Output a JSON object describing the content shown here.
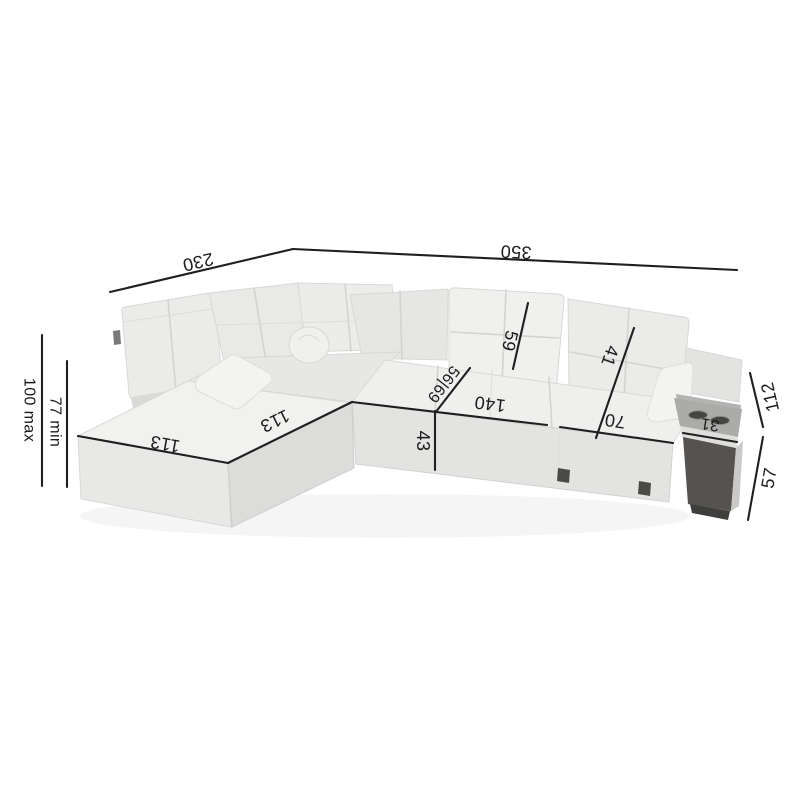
{
  "dims": {
    "total_width": "350",
    "total_depth": "230",
    "height_max": "100 max",
    "height_min": "77 min",
    "chaise_front_length": "113",
    "chaise_inner_depth": "113",
    "center_seat_width": "140",
    "right_seat_width": "70",
    "seat_height": "43",
    "seat_depth_range": "56|69",
    "center_backrest_height": "59",
    "right_backrest_height": "41",
    "table_top_width": "31",
    "table_upper_height": "112",
    "table_lower_height": "57"
  },
  "colors": {
    "background": "#ffffff",
    "dimension_line": "#1f1f1f",
    "dimension_text": "#1b1b1b",
    "fabric_light": "#f1f1ef",
    "fabric_mid": "#e8e8e6",
    "fabric_shade": "#dcdcda",
    "table_top": "#ababa9",
    "table_front": "#565250",
    "cup_holder": "#454543",
    "foot": "#4a4a48"
  }
}
